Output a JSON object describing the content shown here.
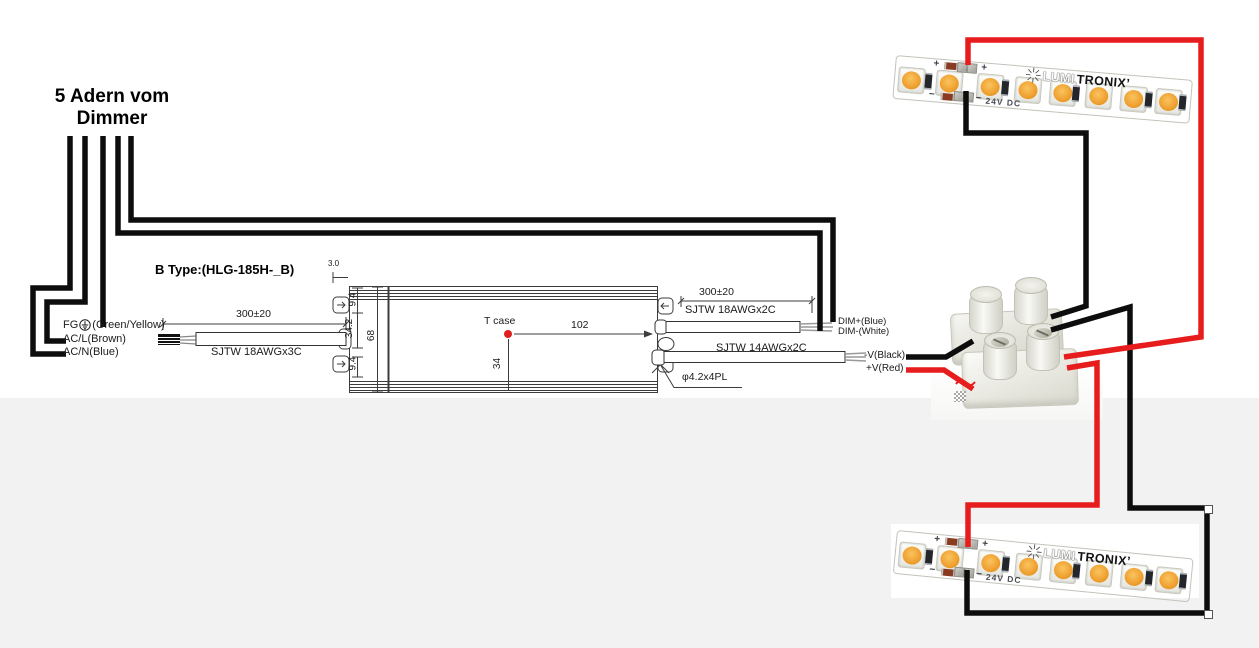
{
  "heading": {
    "line1": "5 Adern vom",
    "line2": "Dimmer"
  },
  "psu": {
    "type_label": "B Type:(HLG-185H-_B)",
    "input": {
      "fg_label": "FG",
      "fg_suffix": "(Green/Yellow)",
      "line_label": "AC/L(Brown)",
      "neutral_label": "AC/N(Blue)",
      "length_dim": "300±20",
      "cable_label": "SJTW 18AWGx3C"
    },
    "dim_output": {
      "length_dim": "300±20",
      "cable_label": "SJTW 18AWGx2C",
      "plus_label": "DIM+(Blue)",
      "minus_label": "DIM-(White)"
    },
    "power_output": {
      "cable_label": "SJTW 14AWGx2C",
      "minus_label": "-V(Black)",
      "plus_label": "+V(Red)"
    },
    "dims": {
      "bracket_offset": "3.0",
      "top": "9.4",
      "middle": "34.2",
      "bottom": "9.4",
      "height": "68",
      "tcase_label": "T case",
      "tcase_x": "102",
      "tcase_y": "34",
      "hole_label": "φ4.2x4PL"
    }
  },
  "strip": {
    "plus_mark": "+",
    "minus_mark": "−",
    "voltage_label": "24V DC",
    "brand_outline": "LUMI",
    "brand_solid": "TRONIX’",
    "led_count": 8
  },
  "colors": {
    "wire_red": "#e71c1c",
    "wire_black": "#0d0d0d",
    "led_amber": "#f0a233",
    "bg_lower": "#f2f2f2",
    "tcase_dot": "#e02020"
  }
}
